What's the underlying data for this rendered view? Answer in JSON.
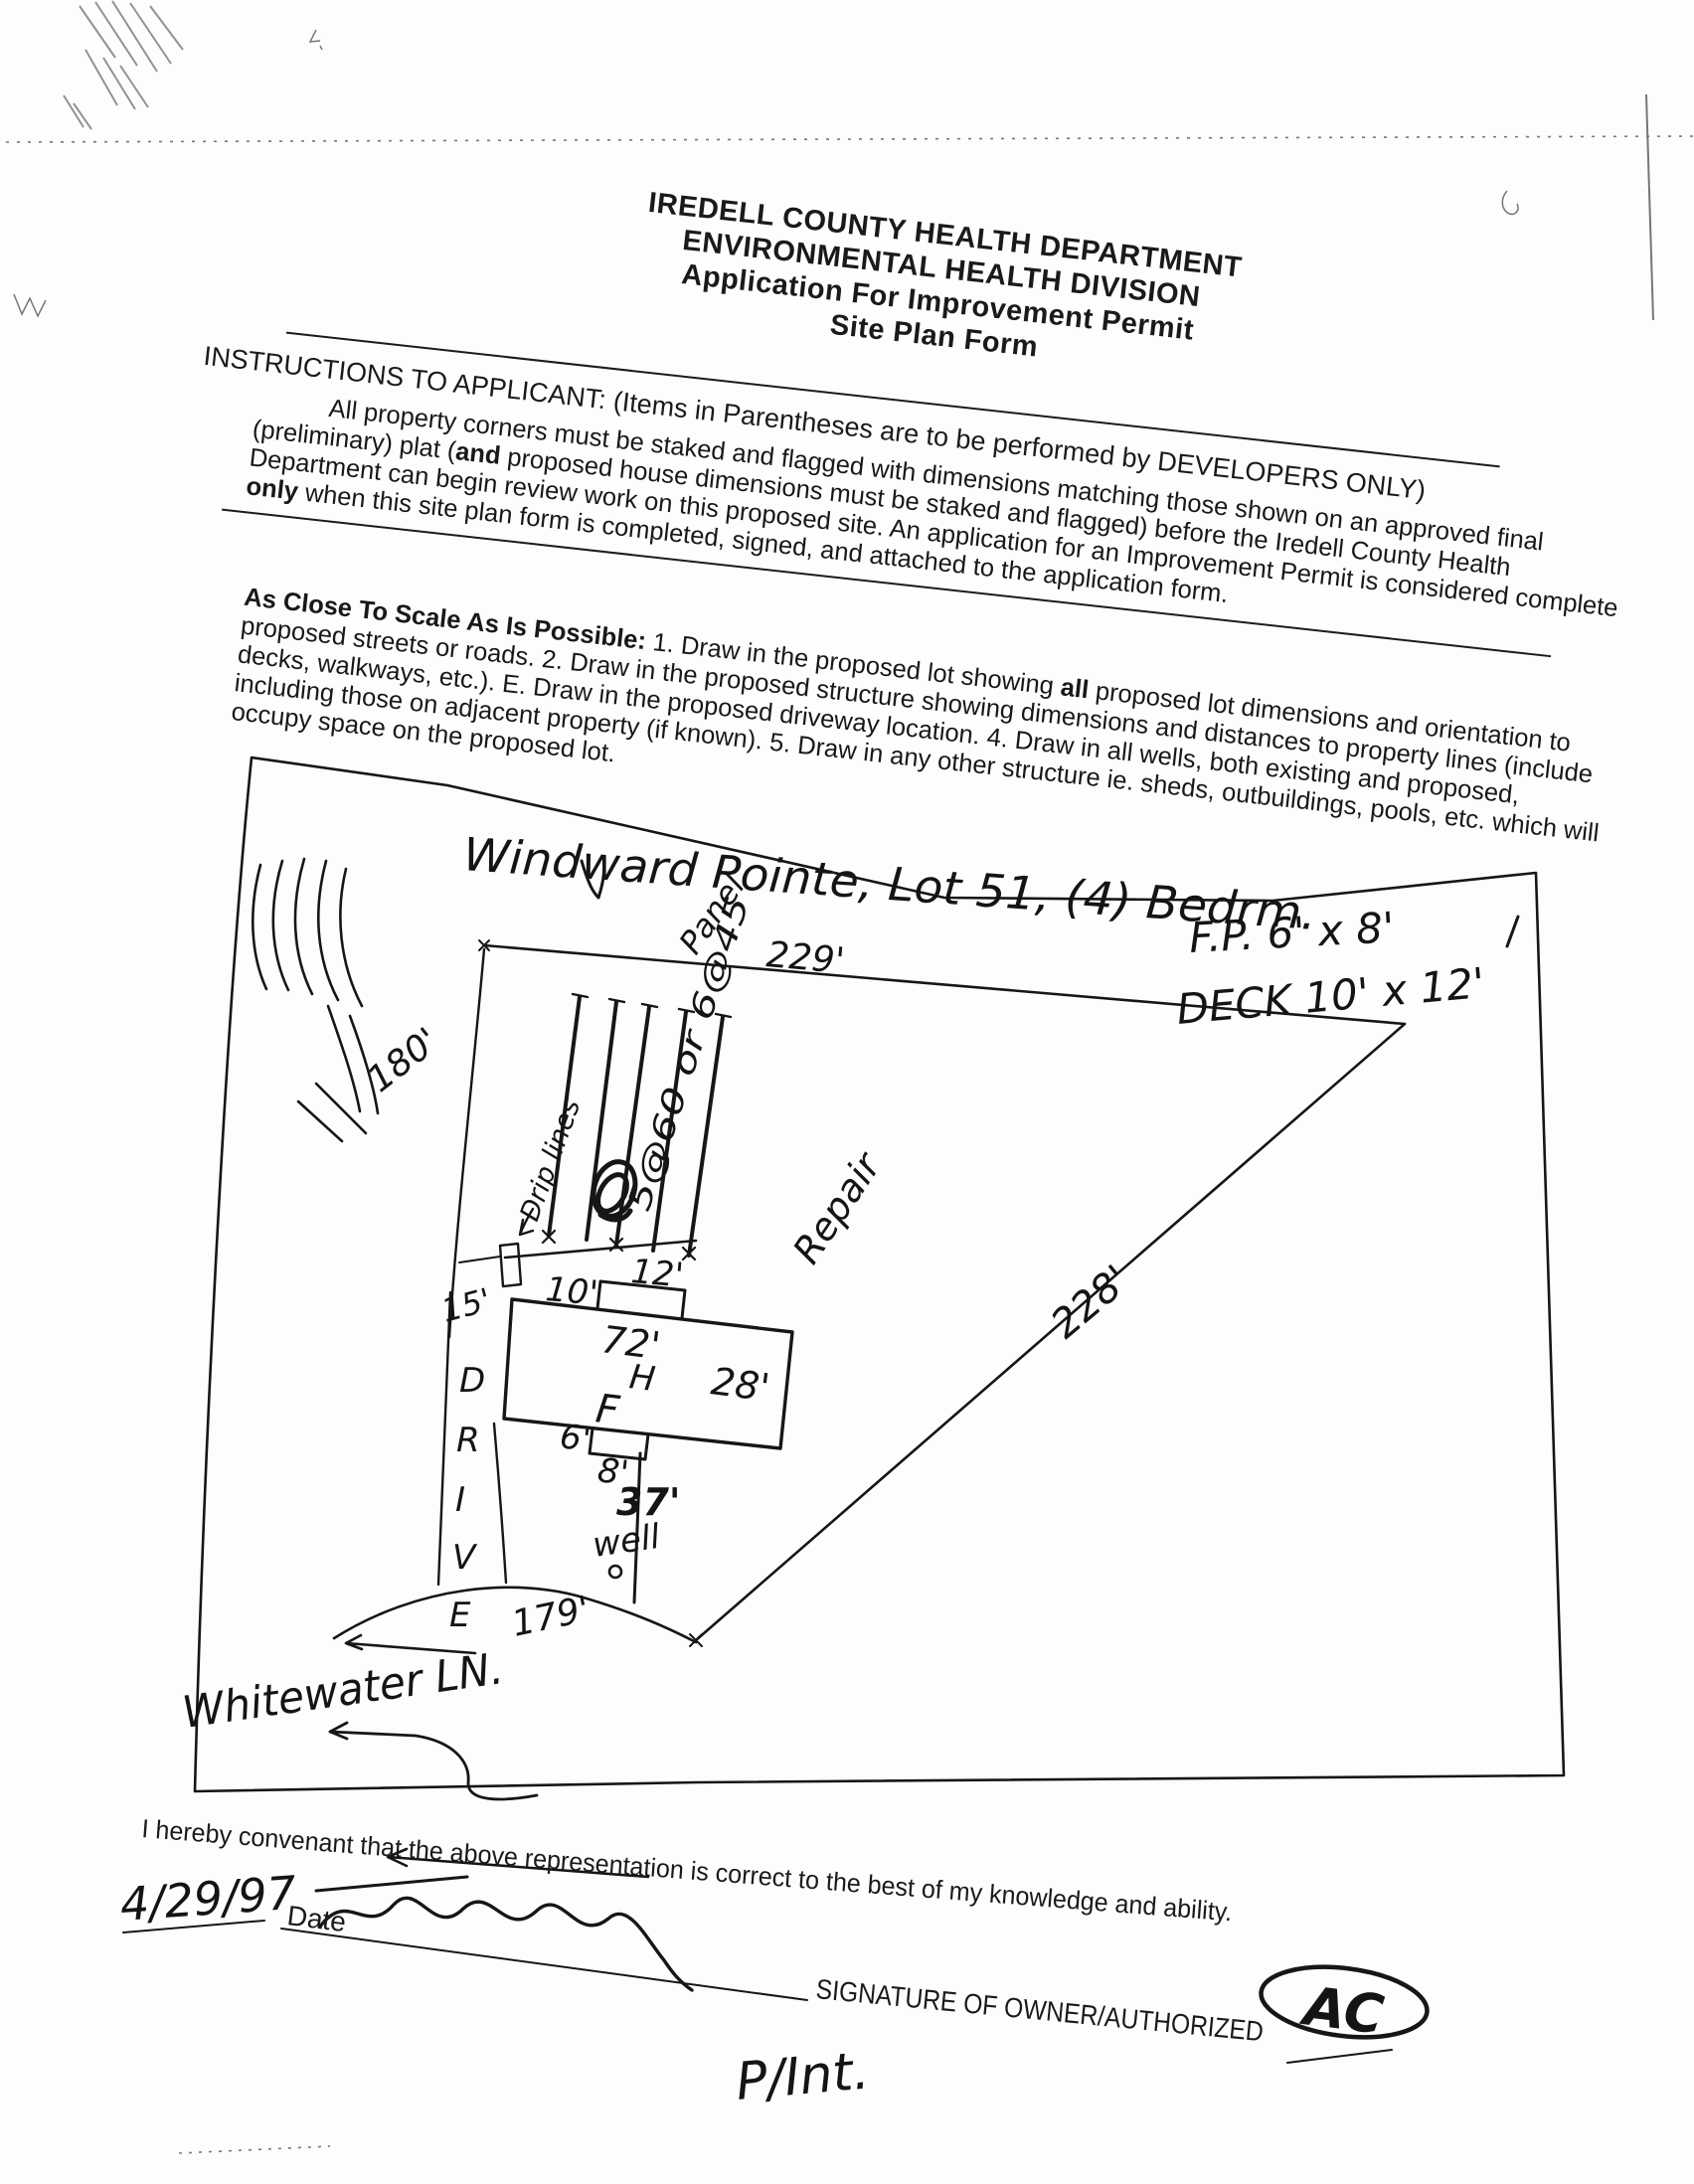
{
  "colors": {
    "ink": "#141414",
    "paper": "#fdfdfc"
  },
  "header": {
    "department": "IREDELL COUNTY HEALTH DEPARTMENT",
    "division": "ENVIRONMENTAL HEALTH DIVISION",
    "application": "Application For Improvement Permit",
    "form": "Site Plan Form"
  },
  "instructions": {
    "heading": "INSTRUCTIONS TO APPLICANT: (Items in Parentheses are to be performed by DEVELOPERS ONLY)",
    "para1_a": "All property corners must be staked and flagged with dimensions matching those shown on an approved final (preliminary) plat (",
    "para1_bold1": "and",
    "para1_b": " proposed house dimensions must be staked and flagged) before the Iredell County Health Department can begin review work on this proposed site. An application for an Improvement Permit is considered complete ",
    "para1_bold2": "only",
    "para1_c": " when this site plan form is completed, signed, and attached to the application form."
  },
  "scale_instructions": {
    "lead": "As Close To Scale As Is Possible:",
    "a": " 1. Draw in the proposed lot showing ",
    "bold_all": "all",
    "b": " proposed lot dimensions and orientation to proposed streets or roads. 2. Draw in the proposed structure showing dimensions and distances to property lines (include decks, walkways, etc.). E. Draw in the proposed driveway location. 4. Draw in all wells, both existing and proposed, including those on adjacent property (if known). 5. Draw in any other structure ie. sheds, outbuildings, pools, etc. which will occupy space on the proposed lot."
  },
  "site_plan": {
    "title": "Windward Pointe, Lot 51, (4) Bedrm.",
    "fp_note": "F.P. 6' x 8'",
    "deck_note": "DECK 10' x 12'",
    "dim_top": "229'",
    "dim_left": "180'",
    "dim_right": "228'",
    "dim_front": "179'",
    "drip_label": "Drip lines",
    "drain_spec": "5@60 or 6@45",
    "drain_spec2": "Panel",
    "house_width": "72'",
    "house_depth": "28'",
    "house_h": "H",
    "house_f": "F",
    "deck_offset": "10'",
    "deck_width": "12'",
    "porch_offset": "6'",
    "porch_width": "8'",
    "setback": "15'",
    "well_dist": "37'",
    "well_label": "well",
    "drive": [
      "D",
      "R",
      "I",
      "V",
      "E"
    ],
    "repair": "Repair",
    "street": "Whitewater LN."
  },
  "footer": {
    "covenant": "I hereby convenant that the above representation is correct to the best of my knowledge and ability.",
    "date_value": "4/29/97",
    "date_label": "Date",
    "sig_label": "SIGNATURE OF OWNER/AUTHORIZED",
    "agent_initials": "AC",
    "bottom_note": "P/Int."
  }
}
